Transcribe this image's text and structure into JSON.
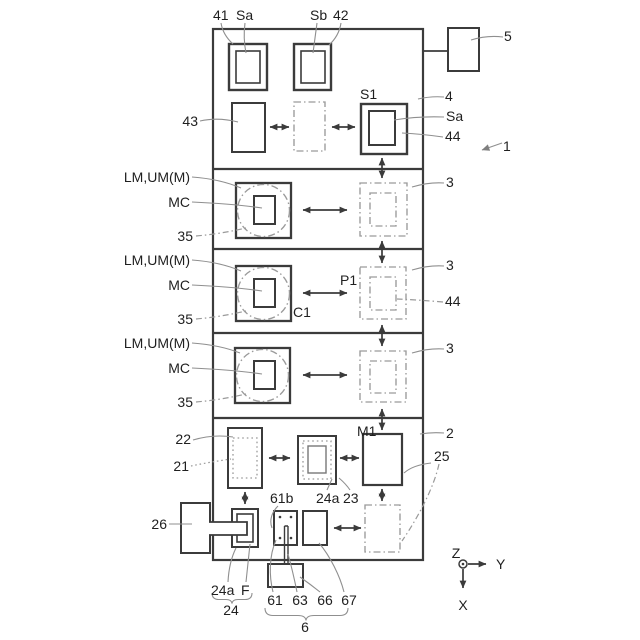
{
  "figure": {
    "top": {
      "n41": "41",
      "sa_left": "Sa",
      "sb": "Sb",
      "n42": "42",
      "n5": "5",
      "n43": "43",
      "s1": "S1",
      "n4": "4",
      "sa_right": "Sa",
      "n44": "44",
      "n1": "1"
    },
    "sections": [
      {
        "lm": "LM,UM(M)",
        "mc": "MC",
        "n35": "35",
        "n3": "3"
      },
      {
        "lm": "LM,UM(M)",
        "mc": "MC",
        "n35": "35",
        "n3": "3",
        "p1": "P1",
        "c1": "C1",
        "n44": "44"
      },
      {
        "lm": "LM,UM(M)",
        "mc": "MC",
        "n35": "35",
        "n3": "3"
      }
    ],
    "bottom": {
      "n22": "22",
      "n21": "21",
      "m1": "M1",
      "n2": "2",
      "n25": "25",
      "n26": "26",
      "n61b": "61b",
      "n24a_top": "24a",
      "n23": "23",
      "n24a": "24a",
      "f": "F",
      "n24": "24",
      "n61": "61",
      "n63": "63",
      "n66": "66",
      "n67": "67",
      "n6": "6"
    },
    "axes": {
      "z": "Z",
      "y": "Y",
      "x": "X"
    },
    "colors": {
      "line_dark": "#3b3b3b",
      "line_gray": "#9a9a9a",
      "leader_gray": "#8f8f8f",
      "text": "#1f1f1f",
      "background": "#ffffff"
    }
  }
}
